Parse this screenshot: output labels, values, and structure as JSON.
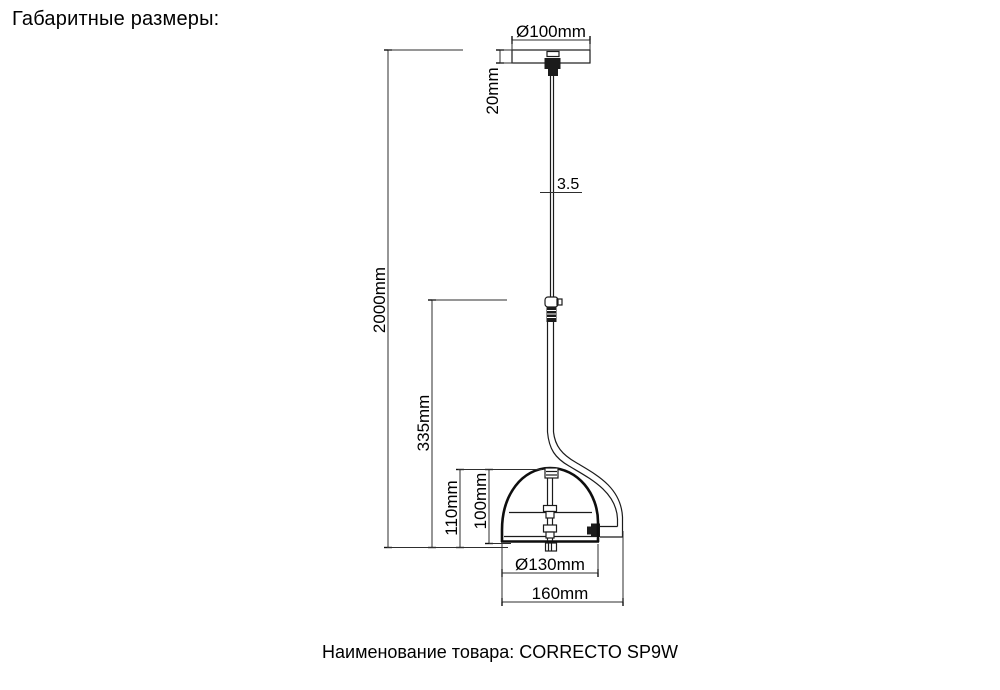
{
  "page": {
    "header": "Габаритные размеры:",
    "footer_text": "Наименование товара: CORRECTO SP9W",
    "product_name": "CORRECTO SP9W"
  },
  "drawing": {
    "type": "technical-dimension-drawing",
    "object": "pendant-lamp",
    "dims": {
      "canopy_diameter": "Ø100mm",
      "canopy_height": "20mm",
      "cord_diameter": "3.5",
      "total_drop": "2000mm",
      "arm_height": "335mm",
      "shade_height_outer": "110mm",
      "shade_height_inner": "100mm",
      "shade_diameter": "Ø130mm",
      "total_width": "160mm"
    }
  }
}
